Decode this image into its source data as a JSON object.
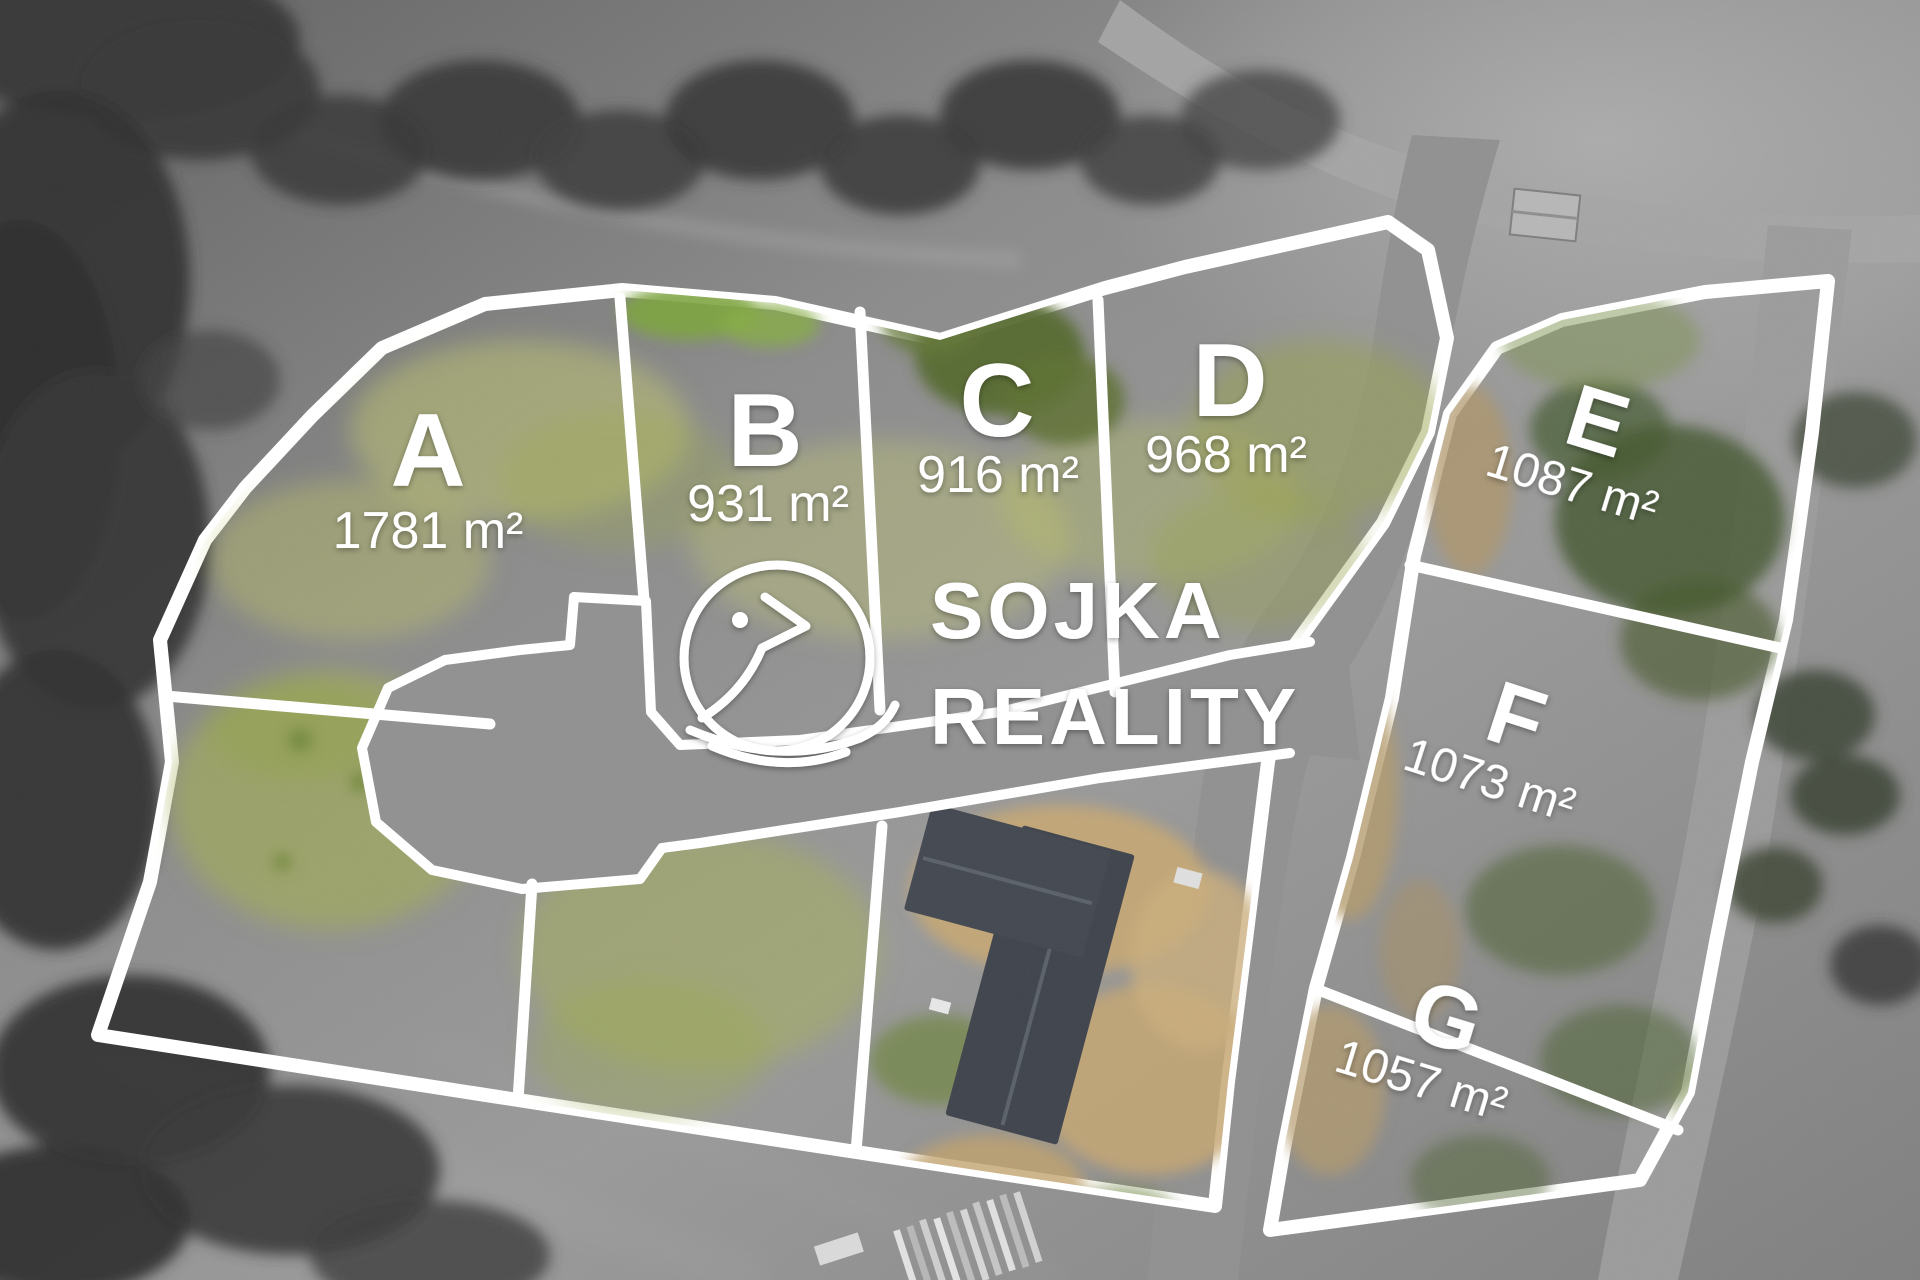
{
  "brand": {
    "name_line1": "SOJKA",
    "name_line2": "REALITY",
    "icon": "bird-icon"
  },
  "plots": [
    {
      "label": "A",
      "area": "1781 m²"
    },
    {
      "label": "B",
      "area": "931 m²"
    },
    {
      "label": "C",
      "area": "916 m²"
    },
    {
      "label": "D",
      "area": "968 m²"
    },
    {
      "label": "E",
      "area": "1087 m²"
    },
    {
      "label": "F",
      "area": "1073 m²"
    },
    {
      "label": "G",
      "area": "1057 m²"
    }
  ],
  "colors": {
    "boundary_white": "#ffffff",
    "plot_green_west": "#aab457",
    "plot_green_east": "#6f8445",
    "road_gray": "#8f8f8f",
    "roof_dark": "#3f434b",
    "sand": "#c3a572"
  }
}
